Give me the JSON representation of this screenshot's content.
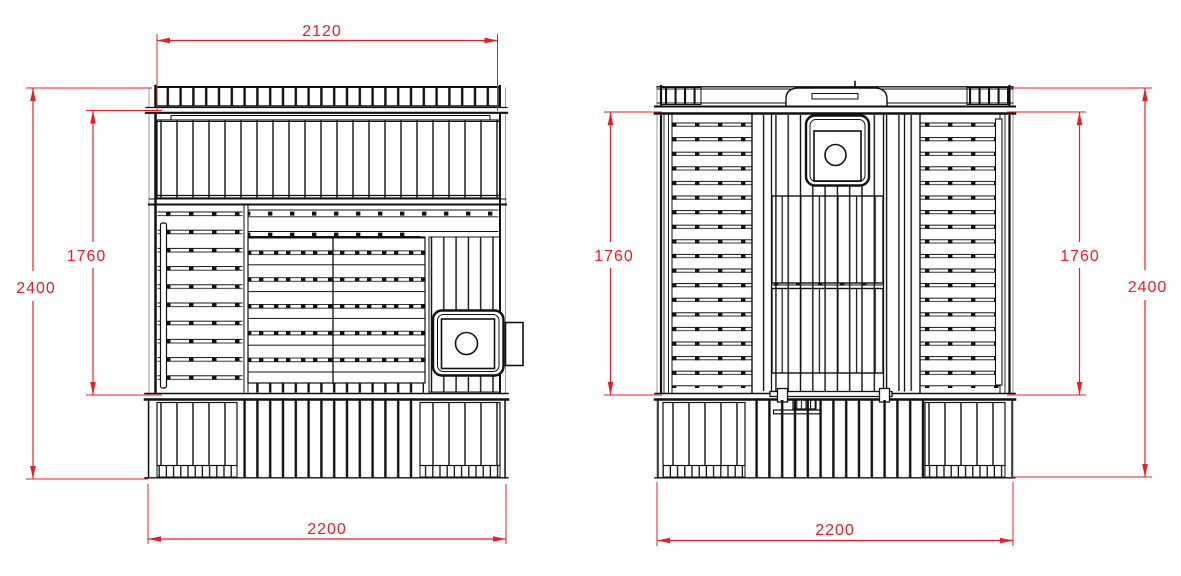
{
  "drawing": {
    "type": "technical-elevation-drawing",
    "subject": "sauna cabin - two elevation views with dimensions",
    "colors": {
      "outline": "#111111",
      "secondary_line": "#9a9a9a",
      "dimension": "#ed1c24",
      "background": "#ffffff"
    },
    "views": [
      {
        "id": "front-elevation",
        "dimensions": [
          {
            "name": "top-width",
            "value": "2120"
          },
          {
            "name": "overall-height",
            "value": "2400"
          },
          {
            "name": "interior-height",
            "value": "1760"
          },
          {
            "name": "overall-width",
            "value": "2200"
          }
        ]
      },
      {
        "id": "rear-elevation",
        "dimensions": [
          {
            "name": "interior-height-left",
            "value": "1760"
          },
          {
            "name": "interior-height-right",
            "value": "1760"
          },
          {
            "name": "overall-height",
            "value": "2400"
          },
          {
            "name": "overall-width",
            "value": "2200"
          }
        ]
      }
    ]
  }
}
